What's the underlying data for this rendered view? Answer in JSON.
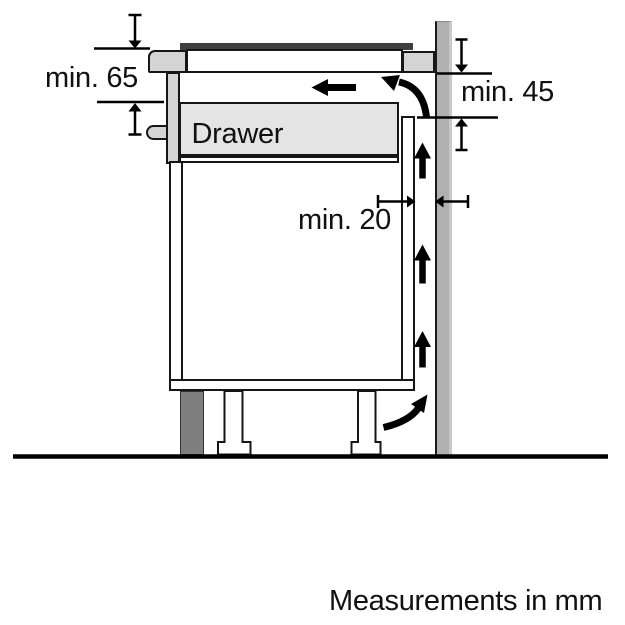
{
  "diagram": {
    "title": "hob-installation-clearance-diagram",
    "labels": {
      "drawer": "Drawer",
      "min65": "min. 65",
      "min45": "min. 45",
      "min20": "min. 20"
    },
    "footnote": "Measurements in mm",
    "dimensions_mm": {
      "clearance_below_worktop": 65,
      "rear_vent_opening_height": 45,
      "gap_to_wall": 20,
      "unit": "mm"
    },
    "colors": {
      "outline": "#161616",
      "worktop_gray": "#d4d4d4",
      "drawer_fill": "#e4e4e4",
      "wall_fill": "#b0b0b0",
      "plinth_fill": "#7f7f7f",
      "hob_glass": "#3f3f3f",
      "arrow_black": "#000000",
      "background": "#ffffff"
    }
  }
}
